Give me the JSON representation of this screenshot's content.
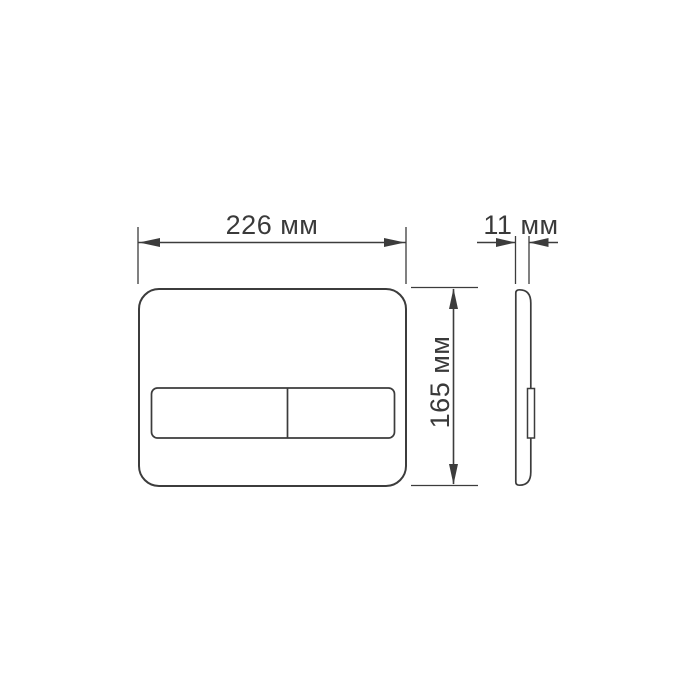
{
  "drawing": {
    "background_color": "#ffffff",
    "line_color": "#3c3c3c",
    "text_color": "#3a3a3a",
    "subject": "flush-plate-dimension-drawing"
  },
  "dimensions": {
    "width": {
      "label": "226 мм",
      "value": 226,
      "unit": "мм"
    },
    "height": {
      "label": "165 мм",
      "value": 165,
      "unit": "мм"
    },
    "depth": {
      "label": "11 мм",
      "value": 11,
      "unit": "мм"
    }
  }
}
